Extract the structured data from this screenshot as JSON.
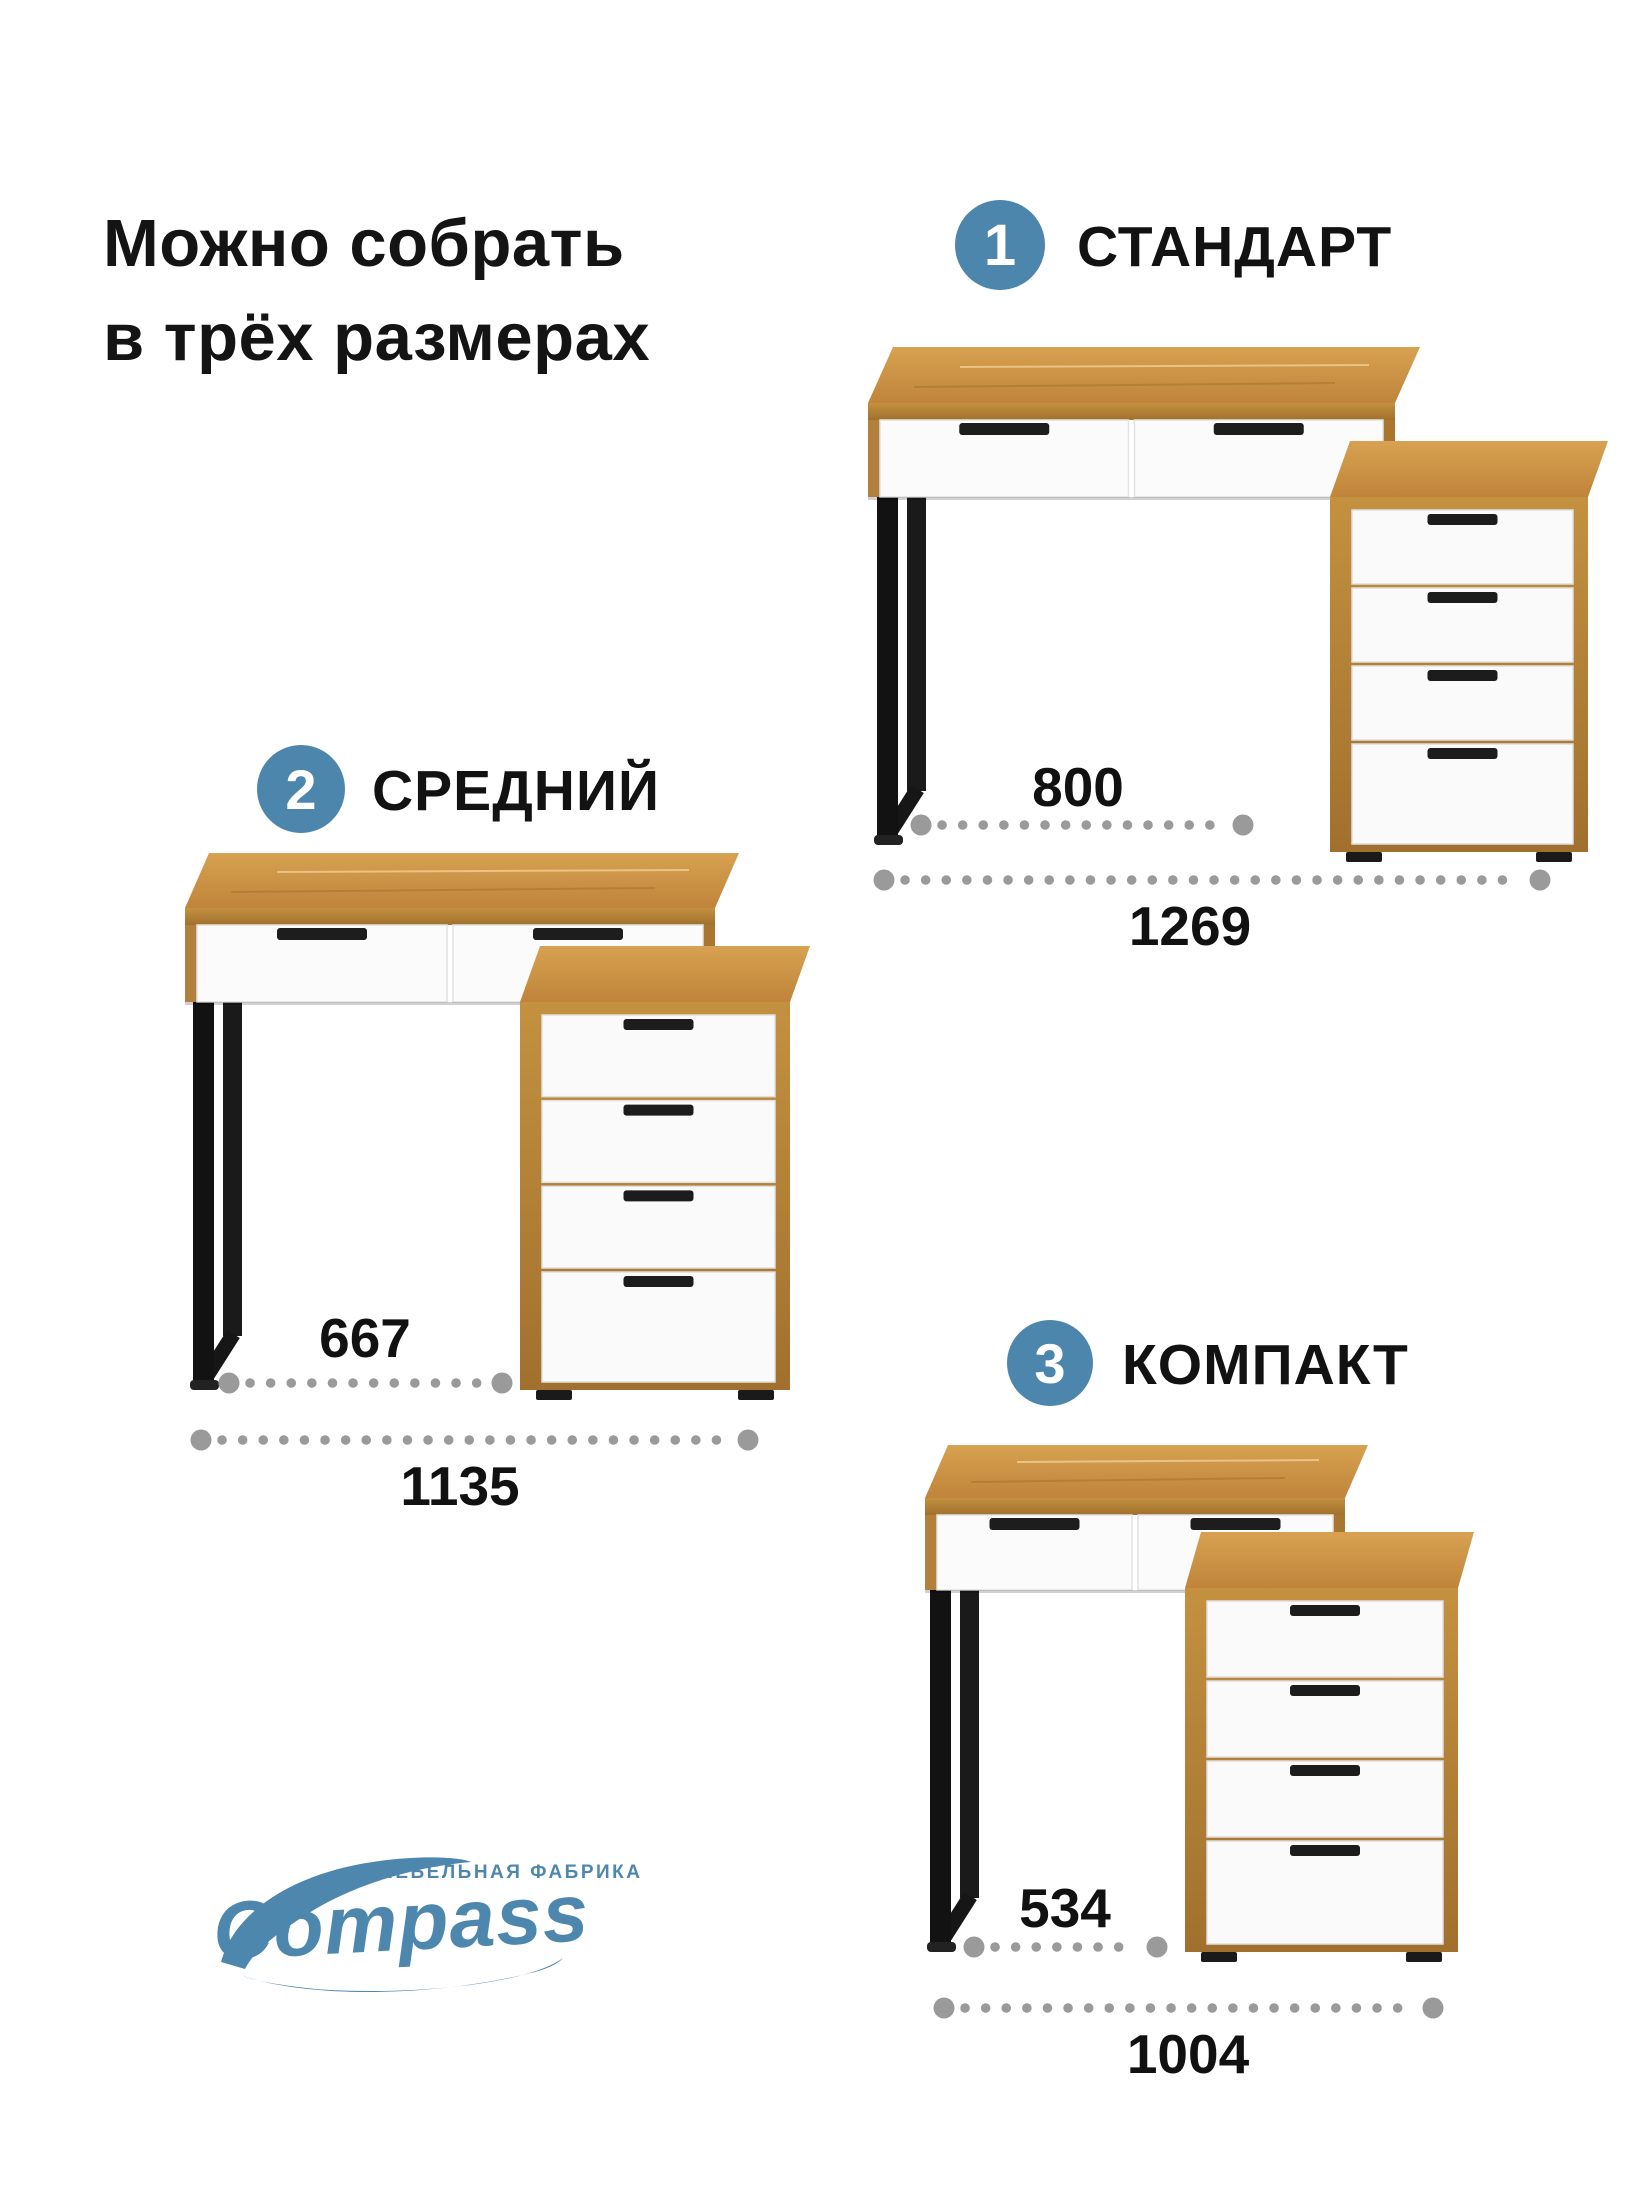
{
  "title": {
    "line1": "Можно собрать",
    "line2": "в трёх размерах"
  },
  "variants": [
    {
      "number": "1",
      "name": "СТАНДАРТ",
      "desk_width": "800",
      "total_width": "1269"
    },
    {
      "number": "2",
      "name": "СРЕДНИЙ",
      "desk_width": "667",
      "total_width": "1135"
    },
    {
      "number": "3",
      "name": "КОМПАКТ",
      "desk_width": "534",
      "total_width": "1004"
    }
  ],
  "logo": {
    "tagline": "МЕБЕЛЬНАЯ ФАБРИКА",
    "brand": "Compass"
  },
  "colors": {
    "badge_blue": "#4d86ac",
    "logo_blue": "#4e87ae",
    "dimension_dots": "#9a9a9a",
    "wood": "#c8913f",
    "drawer_white": "#fafafa",
    "leg_black": "#161616",
    "text_black": "#121212"
  }
}
